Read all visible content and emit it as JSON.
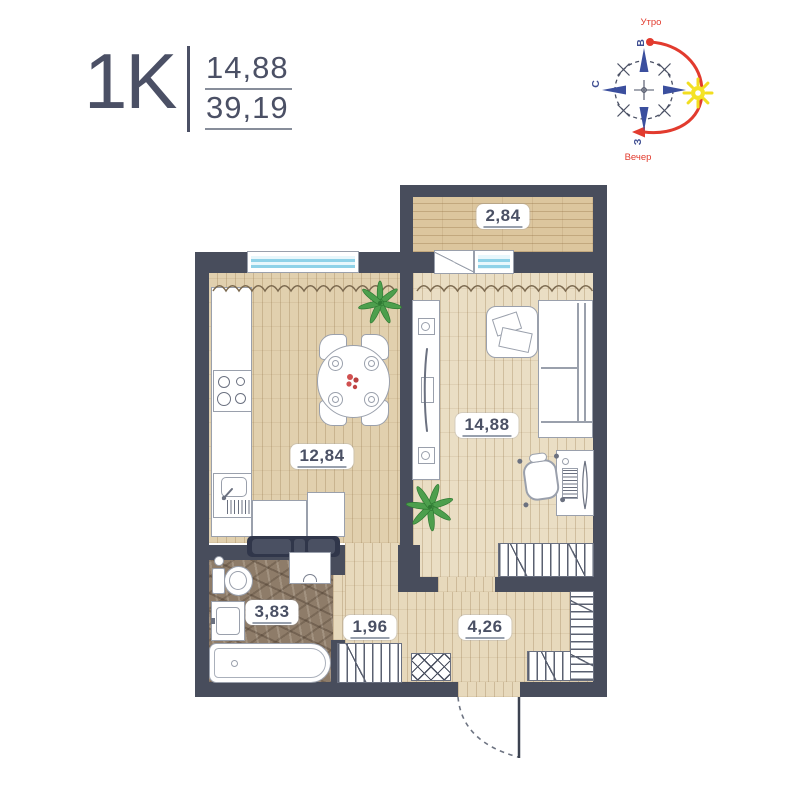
{
  "header": {
    "plan_type": "1K",
    "area_main": "14,88",
    "area_total": "39,19"
  },
  "compass": {
    "morning_label": "Утро",
    "evening_label": "Вечер",
    "dir_east": "В",
    "dir_north": "С",
    "dir_west": "З"
  },
  "rooms": {
    "balcony": {
      "area": "2,84"
    },
    "kitchen": {
      "area": "12,84"
    },
    "living": {
      "area": "14,88"
    },
    "bathroom": {
      "area": "3,83"
    },
    "hall": {
      "area": "1,96"
    },
    "corridor": {
      "area": "4,26"
    }
  },
  "colors": {
    "wall": "#484d5c",
    "accent_text": "#4b5065",
    "compass_blue": "#3b4f9e",
    "compass_red": "#e23b2e",
    "sun_yellow": "#f4e326",
    "window_blue": "#8fd2e8",
    "plant_green": "#4d9f4d",
    "floor_wood": "#e7d9bc",
    "floor_tile": "#8e7c69"
  }
}
